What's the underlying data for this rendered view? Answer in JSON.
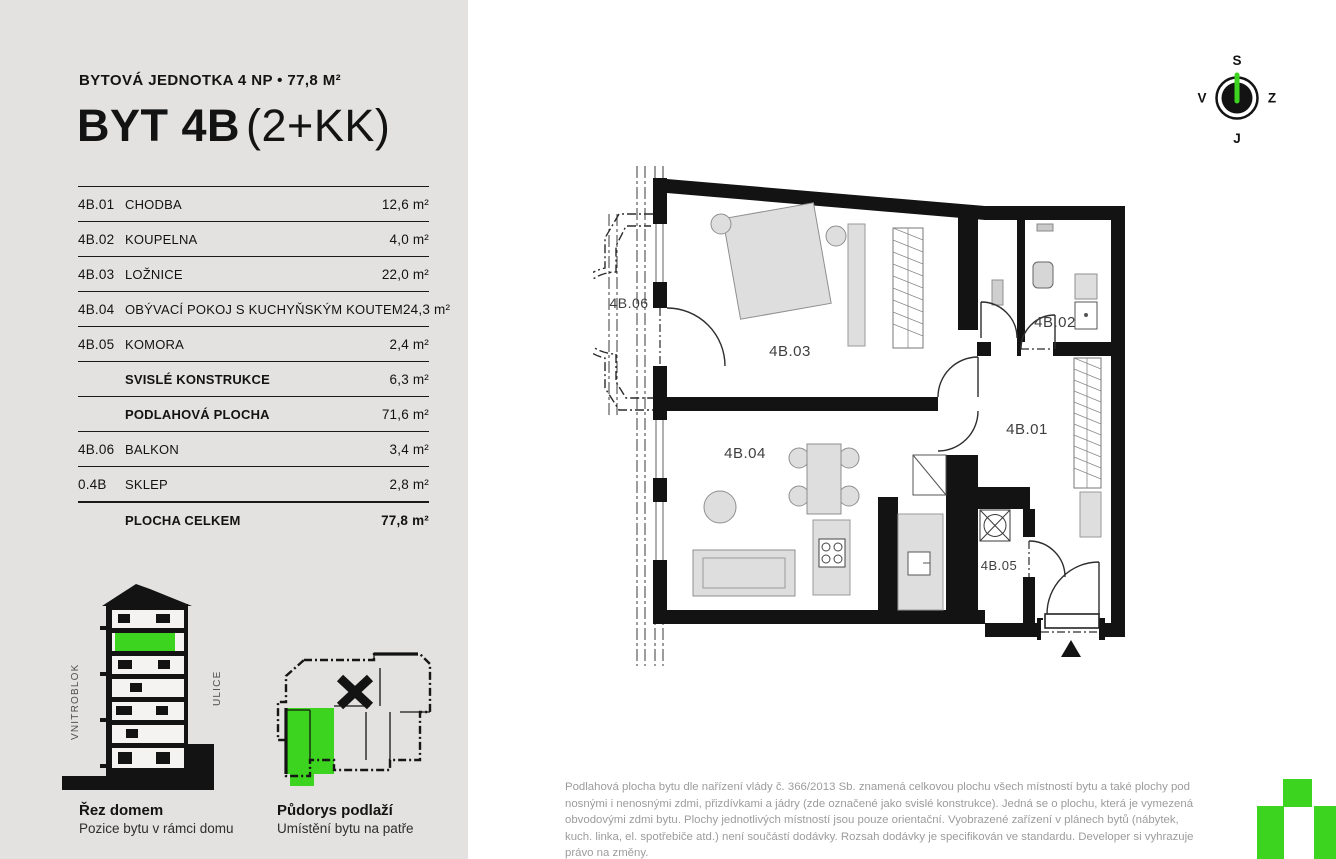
{
  "colors": {
    "panel_bg": "#e3e2e0",
    "green": "#3cd41e",
    "wall": "#131313",
    "furniture": "#dedede",
    "footer_text": "#9c9c9c"
  },
  "header": {
    "subtitle": "BYTOVÁ JEDNOTKA 4 NP • 77,8 M²",
    "title_bold": "BYT 4B",
    "title_light": "(2+KK)"
  },
  "table": {
    "rows": [
      {
        "code": "4B.01",
        "name": "CHODBA",
        "area": "12,6 m²",
        "bold": false,
        "total": false
      },
      {
        "code": "4B.02",
        "name": "KOUPELNA",
        "area": "4,0 m²",
        "bold": false,
        "total": false
      },
      {
        "code": "4B.03",
        "name": "LOŽNICE",
        "area": "22,0 m²",
        "bold": false,
        "total": false
      },
      {
        "code": "4B.04",
        "name": "OBÝVACÍ POKOJ S KUCHYŇSKÝM KOUTEM",
        "area": "24,3 m²",
        "bold": false,
        "total": false
      },
      {
        "code": "4B.05",
        "name": "KOMORA",
        "area": "2,4 m²",
        "bold": false,
        "total": false
      },
      {
        "code": "",
        "name": "SVISLÉ KONSTRUKCE",
        "area": "6,3 m²",
        "bold": true,
        "total": false
      },
      {
        "code": "",
        "name": "PODLAHOVÁ PLOCHA",
        "area": "71,6 m²",
        "bold": true,
        "total": false
      },
      {
        "code": "4B.06",
        "name": "BALKON",
        "area": "3,4 m²",
        "bold": false,
        "total": false
      },
      {
        "code": "0.4B",
        "name": "SKLEP",
        "area": "2,8 m²",
        "bold": false,
        "total": false
      },
      {
        "code": "",
        "name": "PLOCHA CELKEM",
        "area": "77,8 m²",
        "bold": true,
        "total": true
      }
    ]
  },
  "compass": {
    "north": "S",
    "east": "Z",
    "south": "J",
    "west": "V"
  },
  "plan": {
    "labels": {
      "r01": "4B.01",
      "r02": "4B.02",
      "r03": "4B.03",
      "r04": "4B.04",
      "r05": "4B.05",
      "r06": "4B.06"
    }
  },
  "section": {
    "title": "Řez domem",
    "caption": "Pozice bytu v rámci domu",
    "left_label": "VNITROBLOK",
    "right_label": "ULICE"
  },
  "locator": {
    "title": "Půdorys podlaží",
    "caption": "Umístění bytu na patře"
  },
  "footer": {
    "text": "Podlahová plocha bytu dle nařízení vlády č. 366/2013 Sb. znamená celkovou plochu všech místností bytu a také plochy pod nosnými i nenosnými zdmi, přizdívkami a jádry (zde označené jako svislé konstrukce). Jedná se o plochu, která je vymezená obvodovými zdmi bytu. Plochy jednotlivých místností jsou pouze orientační. Vyobrazené zařízení v plánech bytů (nábytek, kuch. linka, el. spotřebiče atd.) není součástí dodávky. Rozsah dodávky je specifikován ve standardu. Developer si vyhrazuje právo na změny."
  }
}
